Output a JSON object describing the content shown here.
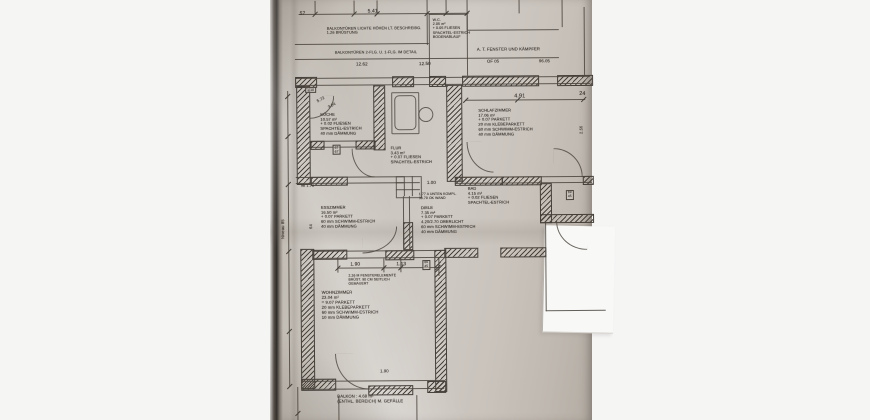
{
  "scene": {
    "background_color": "#f5f5f4",
    "paper_color": "#c9c4bd",
    "paper_edge_shadow_color": "#2f2b27",
    "ink_color": "#4a443d",
    "white_patch_color": "#f8f8f6"
  },
  "plan": {
    "walls": [
      [
        296,
        76,
        20,
        9
      ],
      [
        393,
        76,
        20,
        9
      ],
      [
        430,
        76,
        15,
        9
      ],
      [
        463,
        76,
        75,
        9
      ],
      [
        558,
        76,
        34,
        9
      ],
      [
        297,
        85,
        12,
        97
      ],
      [
        300,
        248,
        12,
        138
      ],
      [
        374,
        85,
        10,
        63
      ],
      [
        447,
        85,
        14,
        95
      ],
      [
        311,
        140,
        12,
        7
      ],
      [
        356,
        140,
        18,
        7
      ],
      [
        311,
        176,
        35,
        7
      ],
      [
        403,
        222,
        8,
        26
      ],
      [
        312,
        249,
        33,
        8
      ],
      [
        385,
        250,
        27,
        8
      ],
      [
        434,
        250,
        10,
        140
      ],
      [
        300,
        378,
        33,
        10
      ],
      [
        367,
        385,
        43,
        8
      ],
      [
        426,
        381,
        17,
        10
      ],
      [
        455,
        177,
        46,
        7
      ],
      [
        502,
        177,
        38,
        7
      ],
      [
        583,
        177,
        9,
        7
      ],
      [
        540,
        184,
        10,
        38
      ],
      [
        540,
        215,
        52,
        7
      ],
      [
        444,
        248,
        32,
        8
      ],
      [
        500,
        248,
        44,
        8
      ]
    ],
    "lines": [
      [
        300,
        13,
        170,
        1
      ],
      [
        316,
        0,
        1,
        14
      ],
      [
        355,
        0,
        1,
        14
      ],
      [
        378,
        0,
        1,
        14
      ],
      [
        447,
        0,
        1,
        14
      ],
      [
        468,
        0,
        1,
        30
      ],
      [
        428,
        0,
        1,
        45
      ],
      [
        563,
        0,
        1,
        28
      ],
      [
        585,
        8,
        1,
        68
      ],
      [
        520,
        0,
        1,
        14
      ],
      [
        430,
        14,
        38,
        1
      ],
      [
        430,
        14,
        1,
        62
      ],
      [
        468,
        14,
        1,
        62
      ],
      [
        296,
        43,
        134,
        1
      ],
      [
        296,
        58,
        264,
        1
      ],
      [
        468,
        30,
        92,
        1
      ],
      [
        296,
        77,
        295,
        1
      ],
      [
        296,
        84,
        295,
        1
      ],
      [
        288,
        90,
        1,
        296
      ],
      [
        466,
        100,
        120,
        1
      ],
      [
        310,
        140,
        65,
        1
      ],
      [
        310,
        146,
        65,
        1
      ],
      [
        296,
        176,
        108,
        1
      ],
      [
        296,
        182,
        108,
        1
      ],
      [
        404,
        176,
        1,
        20
      ],
      [
        412,
        176,
        1,
        20
      ],
      [
        396,
        182,
        24,
        1
      ],
      [
        396,
        189,
        24,
        1
      ],
      [
        403,
        196,
        1,
        52
      ],
      [
        409,
        196,
        1,
        52
      ],
      [
        455,
        177,
        137,
        1
      ],
      [
        455,
        183,
        137,
        1
      ],
      [
        545,
        222,
        1,
        90
      ],
      [
        545,
        311,
        60,
        1
      ],
      [
        312,
        250,
        132,
        1
      ],
      [
        312,
        257,
        132,
        1
      ],
      [
        337,
        267,
        103,
        1
      ],
      [
        337,
        258,
        1,
        14
      ],
      [
        383,
        258,
        1,
        14
      ],
      [
        400,
        258,
        1,
        14
      ],
      [
        438,
        258,
        1,
        18
      ],
      [
        300,
        380,
        143,
        1
      ],
      [
        300,
        388,
        143,
        1
      ],
      [
        337,
        395,
        1,
        25
      ],
      [
        415,
        395,
        1,
        25
      ],
      [
        296,
        386,
        1,
        34
      ]
    ],
    "boxes": [
      {
        "x": 392,
        "y": 92,
        "w": 26,
        "h": 40,
        "r": "1px"
      },
      {
        "x": 395,
        "y": 95,
        "w": 20,
        "h": 33,
        "r": "5px"
      },
      {
        "x": 419,
        "y": 107,
        "w": 13,
        "h": 13,
        "r": "50%"
      },
      {
        "x": 396,
        "y": 176,
        "w": 24,
        "h": 20,
        "r": "0"
      }
    ],
    "arcs": [
      {
        "x": 334,
        "y": 353,
        "w": 33,
        "h": 35,
        "side": "bl"
      },
      {
        "x": 352,
        "y": 148,
        "w": 22,
        "h": 28,
        "side": "bl"
      },
      {
        "x": 310,
        "y": 95,
        "w": 24,
        "h": 22,
        "side": "br"
      },
      {
        "x": 362,
        "y": 226,
        "w": 34,
        "h": 26,
        "side": "br"
      },
      {
        "x": 467,
        "y": 142,
        "w": 26,
        "h": 30,
        "side": "bl"
      },
      {
        "x": 554,
        "y": 149,
        "w": 28,
        "h": 28,
        "side": "tr"
      },
      {
        "x": 556,
        "y": 222,
        "w": 30,
        "h": 28,
        "side": "bl"
      }
    ],
    "ticks": [
      [
        316,
        13
      ],
      [
        355,
        13
      ],
      [
        378,
        13
      ],
      [
        428,
        13
      ],
      [
        447,
        13
      ],
      [
        468,
        13
      ],
      [
        466,
        100
      ],
      [
        518,
        100
      ],
      [
        584,
        100
      ],
      [
        337,
        267
      ],
      [
        383,
        267
      ],
      [
        400,
        267
      ],
      [
        437,
        267
      ],
      [
        288,
        95
      ],
      [
        288,
        135
      ],
      [
        288,
        183
      ],
      [
        288,
        250
      ],
      [
        288,
        330
      ],
      [
        288,
        385
      ],
      [
        296,
        412
      ]
    ],
    "labels": [
      {
        "t": "57",
        "x": 301,
        "y": 11,
        "s": 5
      },
      {
        "t": "5.41",
        "x": 369,
        "y": 9,
        "s": 5
      },
      {
        "t": "BALKONTÜREN LICHTE HÖHEN LT. BESCHREIBG.\n1.26 BRÜSTUNG",
        "x": 328,
        "y": 26,
        "s": 3.8
      },
      {
        "t": "W.C.\n2.05 m²\n+ 0.05 FLIESEN\nSPACHTEL-ESTRICH\nBODENABLAUF",
        "x": 434,
        "y": 18,
        "s": 3.6
      },
      {
        "t": "BALKONTÜREN 2-FLG. U. 1-FLG. IM DETAIL",
        "x": 336,
        "y": 50,
        "s": 3.8
      },
      {
        "t": "12.62",
        "x": 357,
        "y": 61,
        "s": 4.5
      },
      {
        "t": "12.50",
        "x": 420,
        "y": 61,
        "s": 4.5
      },
      {
        "t": "A. T. FENSTER UND KÄMPFER",
        "x": 478,
        "y": 48,
        "s": 4.2
      },
      {
        "t": "OF 05",
        "x": 488,
        "y": 60,
        "s": 4.2
      },
      {
        "t": "96.05",
        "x": 540,
        "y": 60,
        "s": 4.2
      },
      {
        "t": "KÜCHE\n10.57 m²\n+ 0.02 FLIESEN\nSPACHTEL-ESTRICH\n40 mm DÄMMUNG",
        "x": 321,
        "y": 112,
        "s": 4
      },
      {
        "t": "FLUR\n3.43 m²\n+ 0.07 FLIESEN\nSPACHTEL-ESTRICH",
        "x": 391,
        "y": 146,
        "s": 4
      },
      {
        "t": "SCHLAFZIMMER\n17.06 m²\n+ 0.07 PARKETT\n20 mm KLEBEPARKETT\n60 mm SCHWIMM-ESTRICH\n40 mm DÄMMUNG",
        "x": 479,
        "y": 109,
        "s": 4
      },
      {
        "t": "4.91",
        "x": 515,
        "y": 94,
        "s": 5.5
      },
      {
        "t": "24",
        "x": 580,
        "y": 92,
        "s": 5.5
      },
      {
        "t": "ESSZIMMER\n16.50 m²\n+ 0.07 PARKETT\n60 mm SCHWIMM-ESTRICH\n40 mm DÄMMUNG",
        "x": 321,
        "y": 205,
        "s": 4
      },
      {
        "t": "96   1.76",
        "x": 301,
        "y": 183,
        "s": 3.8
      },
      {
        "t": "BAD\n4.15 m²\n+ 0.02 FLIESEN\nSPACHTEL-ESTRICH",
        "x": 468,
        "y": 187,
        "s": 4
      },
      {
        "t": "1.77 A UNTEN KOMPL.\n36.70 OK WAND",
        "x": 419,
        "y": 192,
        "s": 3.4
      },
      {
        "t": "DIELE\n7.35 m²\n+ 0.07 PARKETT\n4.20/2.70 OBERLICHT\n60 mm SCHWIMM-ESTRICH\n40 mm DÄMMUNG",
        "x": 421,
        "y": 206,
        "s": 4
      },
      {
        "t": "1.00",
        "x": 427,
        "y": 180,
        "s": 4.5
      },
      {
        "t": "WOHNZIMMER\n23.04 m²\n= 9.07 PARKETT\n20 mm KLEBEPARKETT\n60 mm SCHWIMM-ESTRICH\n10 mm DÄMMUNG",
        "x": 321,
        "y": 290,
        "s": 4.2
      },
      {
        "t": "1.90",
        "x": 350,
        "y": 262,
        "s": 4.8
      },
      {
        "t": "1.13",
        "x": 396,
        "y": 262,
        "s": 4.8
      },
      {
        "t": "2.26 M FENSTERELEMENTE\nBRÜST. 90 CM SEITLICH\nGEMAUERT",
        "x": 348,
        "y": 273,
        "s": 3.4
      },
      {
        "t": "BALKON : 4.68 m²\n(ENTHL. BEREICH) M. GEFÄLLE",
        "x": 336,
        "y": 394,
        "s": 4.2
      },
      {
        "t": "1.90",
        "x": 379,
        "y": 369,
        "s": 4.2
      },
      {
        "t": "Niveau 85",
        "x": 281,
        "y": 238,
        "s": 4.2,
        "r": -90
      },
      {
        "t": "64",
        "x": 309,
        "y": 228,
        "s": 4,
        "r": -90
      },
      {
        "t": "5.72",
        "x": 317,
        "y": 99,
        "s": 4,
        "r": -28
      },
      {
        "t": "3.04",
        "x": 328,
        "y": 105,
        "s": 4,
        "r": -28
      },
      {
        "t": "2.56",
        "x": 580,
        "y": 135,
        "s": 4,
        "r": -90
      },
      {
        "t": "67\n67",
        "x": 333,
        "y": 144,
        "s": 3.4,
        "box": 1
      },
      {
        "t": "1.10",
        "x": 306,
        "y": 86,
        "s": 3.4,
        "box": 1
      },
      {
        "t": "66\n45",
        "x": 422,
        "y": 260,
        "s": 3.2,
        "box": 1
      },
      {
        "t": "69\n45",
        "x": 566,
        "y": 191,
        "s": 3.2,
        "box": 1
      }
    ]
  }
}
